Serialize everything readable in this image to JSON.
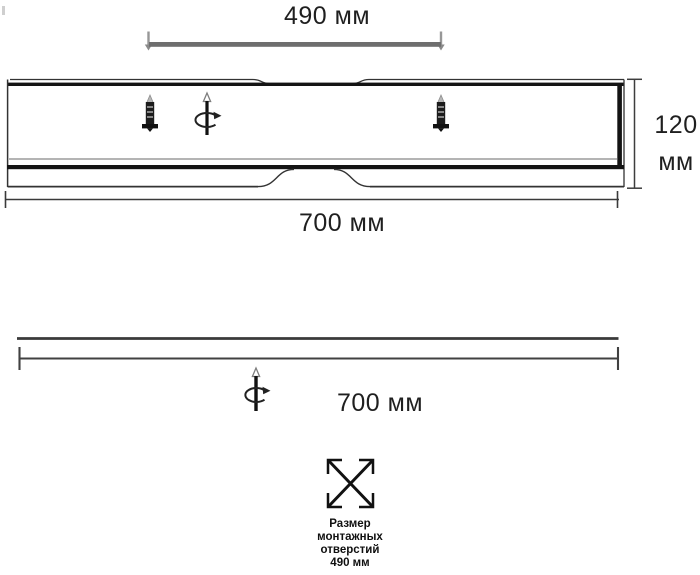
{
  "drawing": {
    "title_hint": "luminaire dimensional drawing",
    "top_mount_dimension": "490 мм",
    "height_dimension": {
      "value": "120",
      "unit": "мм"
    },
    "front_width_dimension": "700 мм",
    "side_width_dimension": "700 мм",
    "mounting_caption": {
      "line1": "Размер",
      "line2": "монтажных",
      "line3": "отверстий",
      "line4": "490 мм"
    }
  },
  "icons": {
    "screw_icon": "self-tapping-screw",
    "rotation_icon": "rotate-around-vertical-axis",
    "mounting_holes_icon": "crossed-square-mounting-holes",
    "mounting_bar_icon": "mounting-bracket-bar"
  },
  "colors": {
    "line": "#2a2a2a",
    "thick_line": "#141414",
    "mounting_bar": "#6e6e6e",
    "pin_gray": "#979797",
    "background": "#ffffff"
  }
}
